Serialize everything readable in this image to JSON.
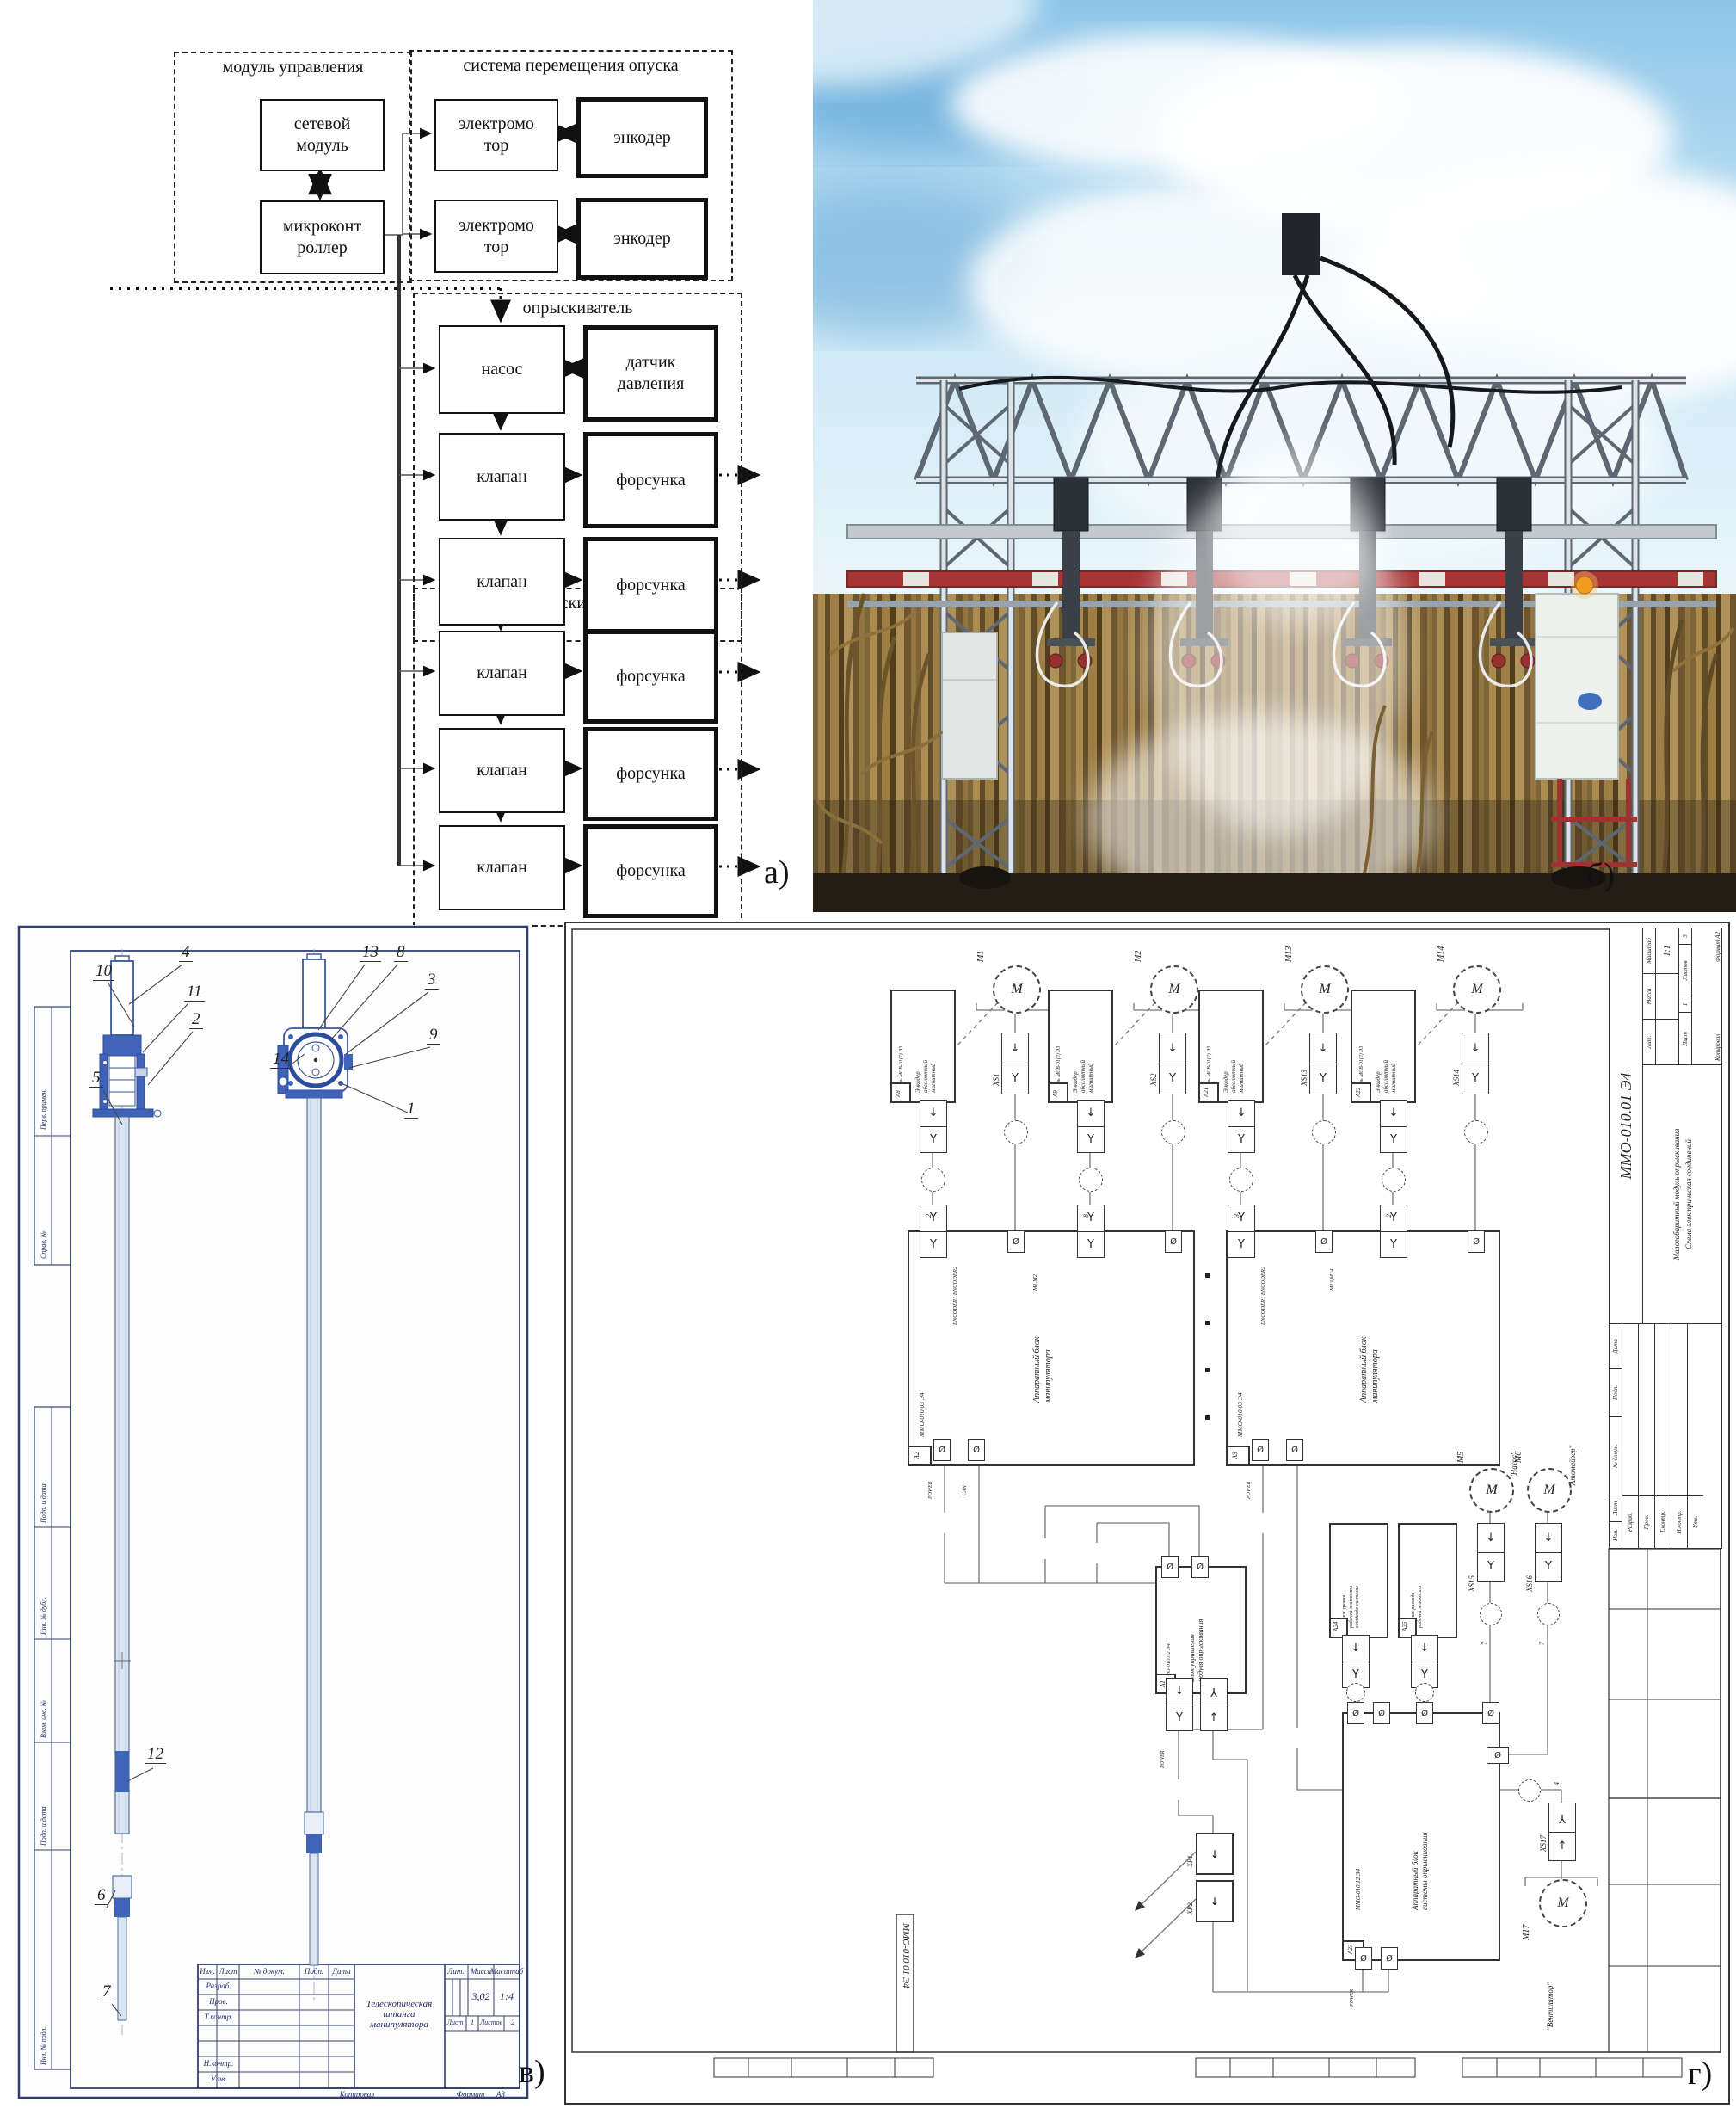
{
  "panel_labels": {
    "a": "а)",
    "b": "б)",
    "v": "в)",
    "g": "г)"
  },
  "colors": {
    "drawing_blue": "#3f63b8",
    "frame_blue": "#31406e",
    "boom_red": "#a93434",
    "beacon_orange": "#f09c22"
  },
  "diagram_a": {
    "group_control": "модуль управления",
    "group_motion": "система перемещения опуска",
    "group_sprayer": "опрыскиватель",
    "blocks": {
      "network": "сетевой\nмодуль",
      "mcu": "микроконт\nроллер",
      "motor": "электромо\nтор",
      "encoder": "энкодер",
      "pump": "насос",
      "pressure": "датчик\nдавления",
      "valve": "клапан",
      "nozzle": "форсунка"
    }
  },
  "drawing_v": {
    "callouts": [
      "10",
      "4",
      "11",
      "2",
      "5",
      "12",
      "6",
      "7",
      "13",
      "8",
      "3",
      "9",
      "14",
      "1"
    ],
    "side_labels": [
      "Перв. примен.",
      "Справ. №",
      "Подп. и дата",
      "Инв. № дубл.",
      "Взам. инв. №",
      "Подп. и дата",
      "Инв. № подл."
    ],
    "title_block": {
      "title": "Телескопическая\nштанга\nманипулятора",
      "header_cols": [
        "Изм.",
        "Лист",
        "№ докум.",
        "Подп.",
        "Дата"
      ],
      "roles": [
        "Разраб.",
        "Пров.",
        "Т.контр.",
        "Н.контр.",
        "Утв."
      ],
      "lit_h": "Лит.",
      "mass_h": "Масса",
      "scale_h": "Масштаб",
      "mass": "3,02",
      "scale": "1:4",
      "sheet_label": "Лист",
      "sheet": "1",
      "sheets_label": "Листов",
      "sheets": "2",
      "copy": "Копировал",
      "format": "Формат",
      "format_val": "А3"
    }
  },
  "schematic_g": {
    "designation": "ММО-010.01 Э4",
    "title": "Малогабаритный модуль опрыскивания",
    "subtitle": "Схема электрическая соединений",
    "encoder_text": "Энкодер\nабсолютный\nмагнитный",
    "encoder_module": "Модуль МСВ-01(2) Э3",
    "motor_symbol": "М",
    "motors": [
      {
        "id": "М1",
        "xs": "XS1",
        "tag": "А8"
      },
      {
        "id": "М2",
        "xs": "XS2",
        "tag": "А9"
      },
      {
        "id": "М13",
        "xs": "XS13",
        "tag": "А21"
      },
      {
        "id": "М14",
        "xs": "XS14",
        "tag": "А22"
      }
    ],
    "manip_block": {
      "text": "Аппаратный блок\nманипулятора",
      "designation": "ММО-010.03 Э4",
      "tags": [
        "А2",
        "А3"
      ],
      "ports_top": "ENCODER1 ENCODER2",
      "ports_motor": [
        "М1,М2",
        "М13,М14"
      ],
      "port_power": "POWER",
      "port_can": "CAN"
    },
    "control_block": {
      "text": "Блок управления\nмодуля опрыскивания",
      "designation": "ММО-010.02 Э4",
      "tag": "А1",
      "port_power": "POWER"
    },
    "system_block": {
      "text": "Аппаратный блок\nсистемы опрыскивания",
      "designation": "ММО-010.12 Э4",
      "tag": "А23",
      "port_power": "POWER"
    },
    "sensors": [
      {
        "tag": "А24",
        "text": "Датчик уровня\nрабочей жидкости\nв подводе системы"
      },
      {
        "tag": "А25",
        "text": "Датчик расхода\nрабочей жидкости"
      }
    ],
    "pump": {
      "id": "М5",
      "caption": "\"Насос\"",
      "xs": "XS15"
    },
    "atomizer": {
      "id": "М6",
      "caption": "\"Атомайзер\"",
      "xs": "XS16"
    },
    "fan": {
      "id": "М17",
      "caption": "\"Вентилятор\"",
      "xs": "XS17"
    },
    "xp": [
      "ХР1",
      "ХР2"
    ],
    "wire_numbers": [
      "2",
      "8",
      "3",
      "2",
      "7",
      "7",
      "4"
    ],
    "stamp": {
      "lit_h": "Лит.",
      "mass_h": "Масса",
      "scale_h": "Масштаб",
      "scale": "1:1",
      "sheet_label": "Лист",
      "sheet": "1",
      "sheets_label": "Листов",
      "sheets": "3",
      "copy": "Копировал",
      "format": "Формат",
      "format_val": "А2",
      "header_cols": [
        "Изм.",
        "Лист",
        "№ докум.",
        "Подп.",
        "Дата"
      ],
      "roles": [
        "Разраб.",
        "Пров.",
        "Т.контр.",
        "Н.контр.",
        "Утв."
      ]
    }
  }
}
